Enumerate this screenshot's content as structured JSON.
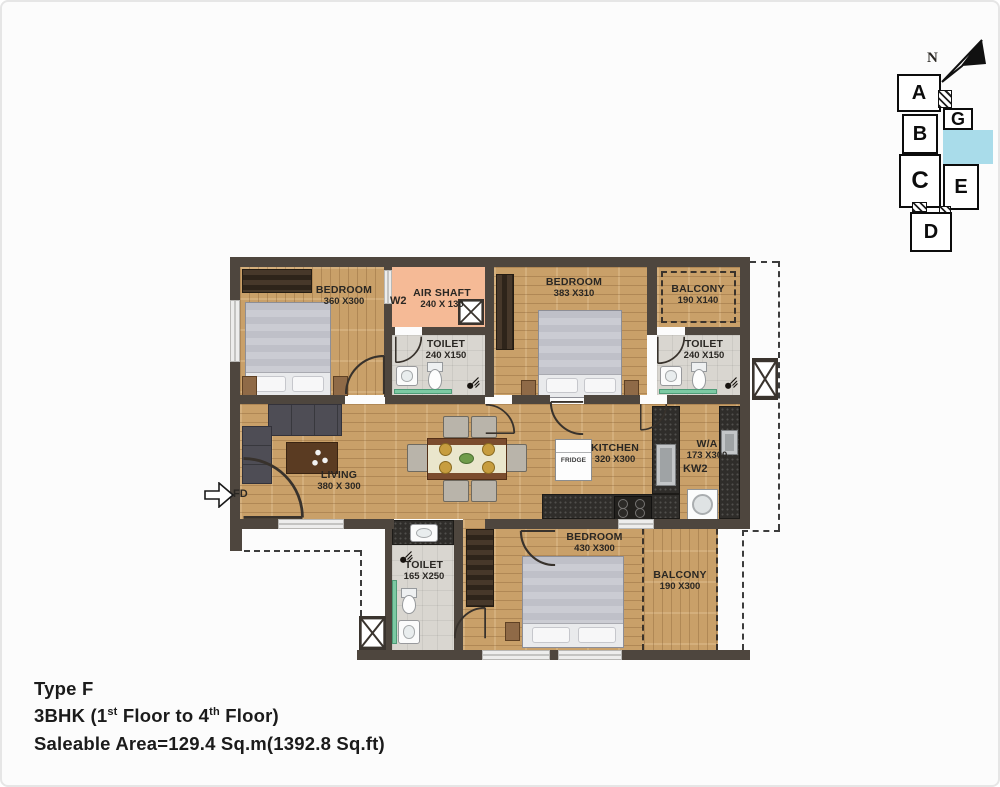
{
  "footer": {
    "line1": "Type F",
    "line2": {
      "p1": "3BHK (1",
      "sup1": "st",
      "p2": " Floor to 4",
      "sup2": "th",
      "p3": " Floor)"
    },
    "line3": "Saleable Area=129.4 Sq.m(1392.8 Sq.ft)"
  },
  "key_plan": {
    "north_label": "N",
    "blocks": [
      {
        "label": "A"
      },
      {
        "label": "B"
      },
      {
        "label": "C"
      },
      {
        "label": "D"
      },
      {
        "label": "G"
      },
      {
        "label": "E"
      }
    ],
    "highlight_color": "#a9dcea"
  },
  "rooms": {
    "bedroom_top_left": {
      "name": "BEDROOM",
      "dims": "360 X300"
    },
    "air_shaft": {
      "window_label": "W2",
      "name": "AIR SHAFT",
      "dims": "240 X 130"
    },
    "toilet_top": {
      "name": "TOILET",
      "dims": "240 X150"
    },
    "bedroom_top_right": {
      "name": "BEDROOM",
      "dims": "383 X310"
    },
    "balcony_top": {
      "name": "BALCONY",
      "dims": "190 X140"
    },
    "toilet_right": {
      "name": "TOILET",
      "dims": "240 X150"
    },
    "living": {
      "name": "LIVING",
      "dims": "380 X 300"
    },
    "kitchen": {
      "name": "KITCHEN",
      "dims": "320 X300"
    },
    "fridge_label": "FRIDGE",
    "wash_area": {
      "name": "W/A",
      "dims": "173 X300",
      "window_label": "KW2"
    },
    "toilet_bottom": {
      "name": "TOILET",
      "dims": "165 X250"
    },
    "bedroom_bottom": {
      "name": "BEDROOM",
      "dims": "430 X300"
    },
    "balcony_bottom": {
      "name": "BALCONY",
      "dims": "190 X300"
    },
    "entrance_label": "FD"
  },
  "colors": {
    "wood": "#c9a069",
    "wall": "#4e463e",
    "tile": "#d9d5d0",
    "air_shaft": "#f5ba96",
    "key_highlight": "#a9dcea",
    "glass_green": "#7cc9a3",
    "granite": "#2f2d2a"
  }
}
